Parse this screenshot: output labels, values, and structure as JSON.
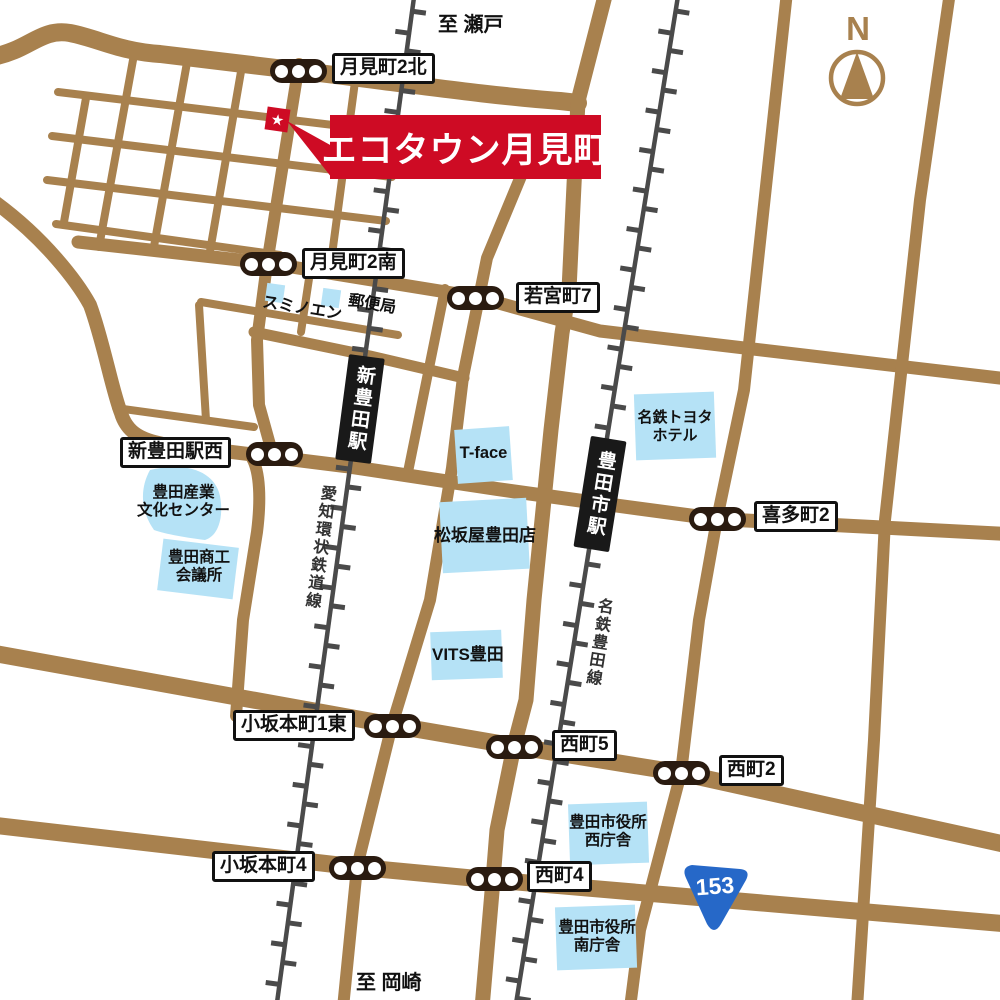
{
  "map": {
    "banner": {
      "label": "エコタウン月見町",
      "marker": "★"
    },
    "compass": {
      "label": "N"
    },
    "directions": {
      "north": "至 瀬戸",
      "south": "至 岡崎"
    },
    "route_shield": {
      "number": "153"
    },
    "railways": [
      {
        "name": "愛知環状鉄道線"
      },
      {
        "name": "名鉄豊田線"
      }
    ],
    "stations": [
      {
        "name": "新豊田駅"
      },
      {
        "name": "豊田市駅"
      }
    ],
    "signals": [
      {
        "label": "月見町2北"
      },
      {
        "label": "月見町2南"
      },
      {
        "label": "若宮町7"
      },
      {
        "label": "新豊田駅西"
      },
      {
        "label": "喜多町2"
      },
      {
        "label": "小坂本町1東"
      },
      {
        "label": "西町5"
      },
      {
        "label": "西町2"
      },
      {
        "label": "小坂本町4"
      },
      {
        "label": "西町4"
      }
    ],
    "landmarks": [
      {
        "label": "スミノエン"
      },
      {
        "label": "郵便局"
      },
      {
        "label": "T-face"
      },
      {
        "label": "名鉄トヨタ\nホテル"
      },
      {
        "label": "豊田産業\n文化センター"
      },
      {
        "label": "豊田商工\n会議所"
      },
      {
        "label": "松坂屋豊田店"
      },
      {
        "label": "VITS豊田"
      },
      {
        "label": "豊田市役所\n西庁舎"
      },
      {
        "label": "豊田市役所\n南庁舎"
      }
    ],
    "colors": {
      "road_brown": "#A8814E",
      "railway_gray": "#4A4A4A",
      "signal_black": "#2A1B10",
      "landmark_blue": "#B5E2F6",
      "accent_red": "#CE0B24",
      "shield_blue": "#2668C8"
    }
  }
}
